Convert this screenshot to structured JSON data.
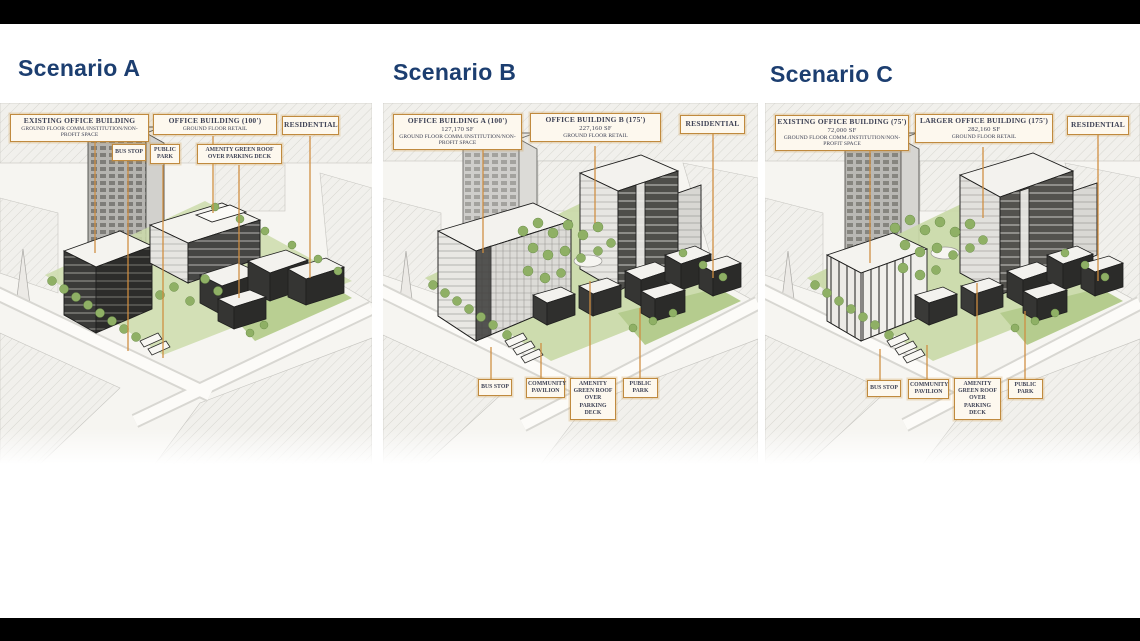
{
  "slide": {
    "type": "architectural-scenario-comparison",
    "letterbox_color": "#000000",
    "background": "#ffffff"
  },
  "colors": {
    "title_text": "#1c3e70",
    "label_border": "#c08a3e",
    "label_background": "#fdf8ee",
    "label_text": "#3f4356",
    "leader_line": "#cf8d3f",
    "greenery": "#8fb065"
  },
  "scenarios": [
    {
      "title": "Scenario A",
      "building_labels": [
        {
          "title": "EXISTING OFFICE BUILDING",
          "subtitle": "GROUND FLOOR COMM./INSTITUTION/NON-PROFIT SPACE"
        },
        {
          "title": "OFFICE BUILDING (100')",
          "subtitle": "GROUND FLOOR RETAIL"
        },
        {
          "title": "RESIDENTIAL"
        }
      ],
      "site_labels": [
        "BUS STOP",
        "PUBLIC PARK",
        "AMENITY GREEN ROOF OVER PARKING DECK"
      ]
    },
    {
      "title": "Scenario B",
      "building_labels": [
        {
          "title": "OFFICE BUILDING A (100')",
          "sf": "127,170 SF",
          "subtitle": "GROUND FLOOR COMM./INSTITUTION/NON-PROFIT SPACE"
        },
        {
          "title": "OFFICE BUILDING B (175')",
          "sf": "227,160 SF",
          "subtitle": "GROUND FLOOR RETAIL"
        },
        {
          "title": "RESIDENTIAL"
        }
      ],
      "site_labels": [
        "BUS STOP",
        "COMMUNITY PAVILION",
        "AMENITY GREEN ROOF OVER PARKING DECK",
        "PUBLIC PARK"
      ]
    },
    {
      "title": "Scenario C",
      "building_labels": [
        {
          "title": "EXISTING OFFICE BUILDING (75')",
          "sf": "72,000 SF",
          "subtitle": "GROUND FLOOR COMM./INSTITUTION/NON-PROFIT SPACE"
        },
        {
          "title": "LARGER OFFICE BUILDING (175')",
          "sf": "282,160 SF",
          "subtitle": "GROUND FLOOR RETAIL"
        },
        {
          "title": "RESIDENTIAL"
        }
      ],
      "site_labels": [
        "BUS STOP",
        "COMMUNITY PAVILION",
        "AMENITY GREEN ROOF OVER PARKING DECK",
        "PUBLIC PARK"
      ]
    }
  ]
}
